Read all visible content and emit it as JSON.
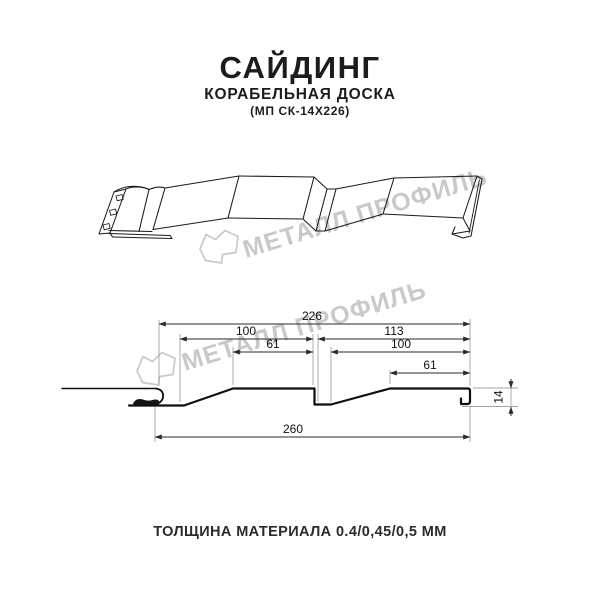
{
  "header": {
    "title": "САЙДИНГ",
    "subtitle": "КОРАБЕЛЬНАЯ ДОСКА",
    "model": "(МП СК-14Х226)"
  },
  "watermark": {
    "brand": "МЕТАЛЛ ПРОФИЛЬ",
    "color": "#c9c9c9"
  },
  "cross_section": {
    "dim_overall_top": "226",
    "dim_board1_top": "100",
    "dim_board2_top": "113",
    "dim_board1_inner": "61",
    "dim_board2_inner": "100",
    "dim_board2_small": "61",
    "dim_overall_bottom": "260",
    "dim_profile_height": "14"
  },
  "footer": {
    "thickness": "ТОЛЩИНА МАТЕРИАЛА 0.4/0,45/0,5 ММ"
  },
  "colors": {
    "line": "#1b1b1b",
    "dimension_line": "#2a2a2a",
    "extension_line": "#a3a3a3",
    "watermark": "#c9c9c9"
  }
}
